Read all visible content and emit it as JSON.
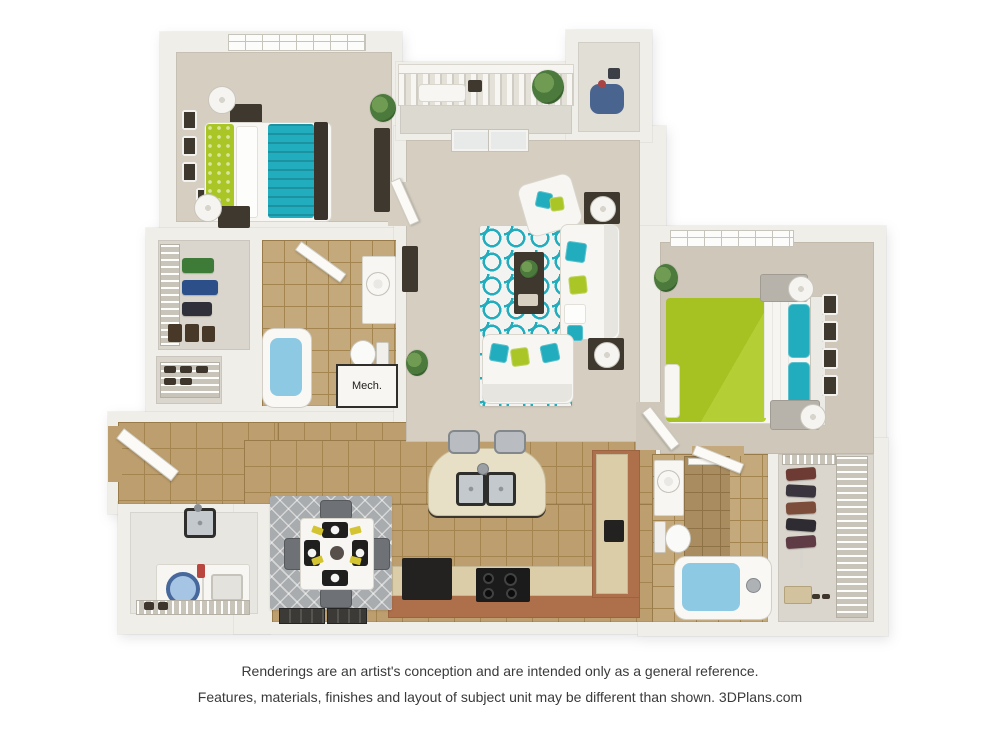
{
  "disclaimer": {
    "line1": "Renderings are an artist's conception and are intended only as a general reference.",
    "line2": "Features, materials, finishes and layout of subject unit may be different than shown. 3DPlans.com"
  },
  "plan": {
    "type": "3d-floor-plan",
    "unit": "2 bedroom / 2 bathroom apartment",
    "labels": {
      "mech_closet": "Mech."
    },
    "colors": {
      "wall": "#f0eee8",
      "wallEdge": "#d7d4ca",
      "carpet": "#d5cec1",
      "carpet2": "#cfc8ba",
      "closetFloor": "#dad6cd",
      "balconyFloor": "#dcd9d1",
      "storageFloor": "#e1ded6",
      "laundryFloor": "#e8e6e0",
      "tile": "#bd9e6e",
      "tileGrout": "#a5854f",
      "tileBath": "#c4a97c",
      "teal": "#21adbd",
      "lime": "#a9c626",
      "rugWhite": "#f3f4f1",
      "rugGray": "#a9acae",
      "counterBrown": "#ae6f4b",
      "counterTop": "#dccda9",
      "darkWood": "#3f382f",
      "applianceDark": "#232220",
      "water": "#8ec9e4",
      "white": "#f7f6f3"
    },
    "rooms": [
      {
        "name": "bedroom-1",
        "position": "top-left",
        "furniture": [
          "bed-with-teal-blanket-and-lime-pillows",
          "dark-headboard",
          "two-nightstands",
          "two-lamps",
          "tall-dresser",
          "wall-art",
          "window",
          "plant"
        ]
      },
      {
        "name": "balcony",
        "position": "top-center",
        "furniture": [
          "railing",
          "patio-bench",
          "side-table",
          "plant"
        ]
      },
      {
        "name": "outdoor-storage",
        "position": "top-right-of-balcony",
        "furniture": [
          "stored-items"
        ]
      },
      {
        "name": "living-room",
        "position": "center",
        "furniture": [
          "french-doors",
          "sofa",
          "loveseat",
          "armchair",
          "coffee-table",
          "media-console",
          "two-side-tables-with-lamps",
          "teal-trellis-rug",
          "plants"
        ]
      },
      {
        "name": "bedroom-2",
        "position": "right",
        "furniture": [
          "bed-with-lime-duvet-and-teal-pillows",
          "white-headboard",
          "two-nightstands",
          "two-lamps",
          "dresser",
          "wall-art",
          "window",
          "plant"
        ]
      },
      {
        "name": "walk-in-closet-1",
        "position": "left-middle",
        "furniture": [
          "wire-shelving",
          "hanging-clothes",
          "boots"
        ]
      },
      {
        "name": "shoe-closet",
        "position": "left-middle",
        "furniture": [
          "wire-rack",
          "shoes"
        ]
      },
      {
        "name": "bathroom-1",
        "position": "left-middle",
        "furniture": [
          "bathtub",
          "toilet",
          "vanity-sink"
        ]
      },
      {
        "name": "mechanical-closet",
        "position": "center-left",
        "label": "Mech."
      },
      {
        "name": "entry",
        "position": "bottom-left",
        "furniture": [
          "front-door",
          "utility-sink"
        ]
      },
      {
        "name": "laundry-closet",
        "position": "bottom-left",
        "furniture": [
          "washer",
          "dryer",
          "wire-shelf",
          "detergent"
        ]
      },
      {
        "name": "dining-area",
        "position": "bottom-center-left",
        "furniture": [
          "square-table",
          "four-chairs",
          "four-place-settings",
          "gray-diamond-rug",
          "two-windows"
        ]
      },
      {
        "name": "kitchen",
        "position": "bottom-center",
        "furniture": [
          "l-shaped-counter",
          "refrigerator",
          "range",
          "curved-island-with-double-sink",
          "two-bar-stools",
          "coffee-maker"
        ]
      },
      {
        "name": "bathroom-2",
        "position": "bottom-right",
        "furniture": [
          "bathtub",
          "toilet",
          "vanity-sink",
          "shower-wall",
          "towel-bar"
        ]
      },
      {
        "name": "walk-in-closet-2",
        "position": "bottom-right",
        "furniture": [
          "wire-shelving",
          "hanging-clothes",
          "shoe-boxes"
        ]
      }
    ]
  }
}
